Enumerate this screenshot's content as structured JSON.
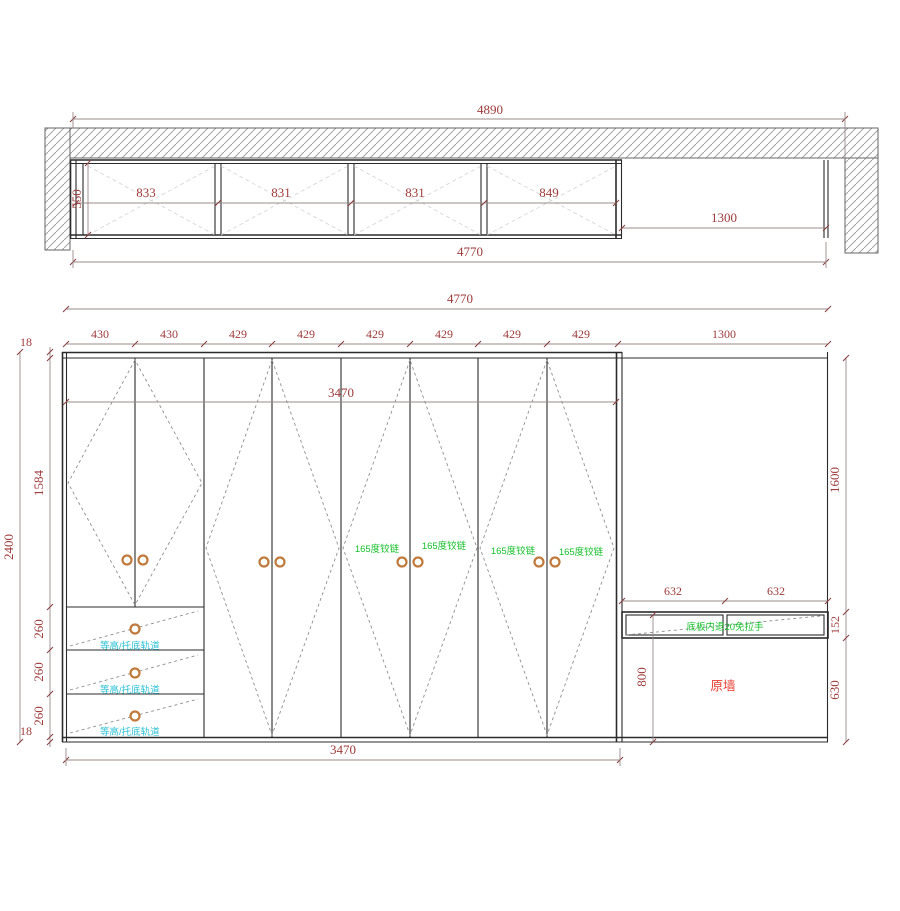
{
  "plan": {
    "overall_width": "4890",
    "inner_width": "4770",
    "depth": "550",
    "compartments": [
      "833",
      "831",
      "831",
      "849"
    ],
    "niche_width": "1300"
  },
  "elevation": {
    "total_width": "4770",
    "door_widths": [
      "430",
      "430",
      "429",
      "429",
      "429",
      "429",
      "429",
      "429"
    ],
    "niche_width": "1300",
    "body_width_top": "3470",
    "body_width_bottom": "3470",
    "top_panel_thickness": "18",
    "door_section_height": "1584",
    "drawer_heights": [
      "260",
      "260",
      "260"
    ],
    "bottom_panel_thickness": "18",
    "total_height": "2400",
    "niche_upper_height": "1600",
    "niche_drawer_height": "152",
    "niche_lower_height": "630",
    "niche_drawer_widths": [
      "632",
      "632"
    ],
    "niche_drawer_top_offset": "800",
    "wall_label": "原墙",
    "hinge_label": "165度铰链",
    "rail_label": "等高/托底轨道",
    "niche_note": "底板内退20免拉手"
  },
  "colors": {
    "dimension_text": "#9e3b3b",
    "hinge_green": "#17c02c",
    "rail_cyan": "#2ac0d4",
    "wall_red": "#e83a2e",
    "outline": "#2b2b2b"
  }
}
